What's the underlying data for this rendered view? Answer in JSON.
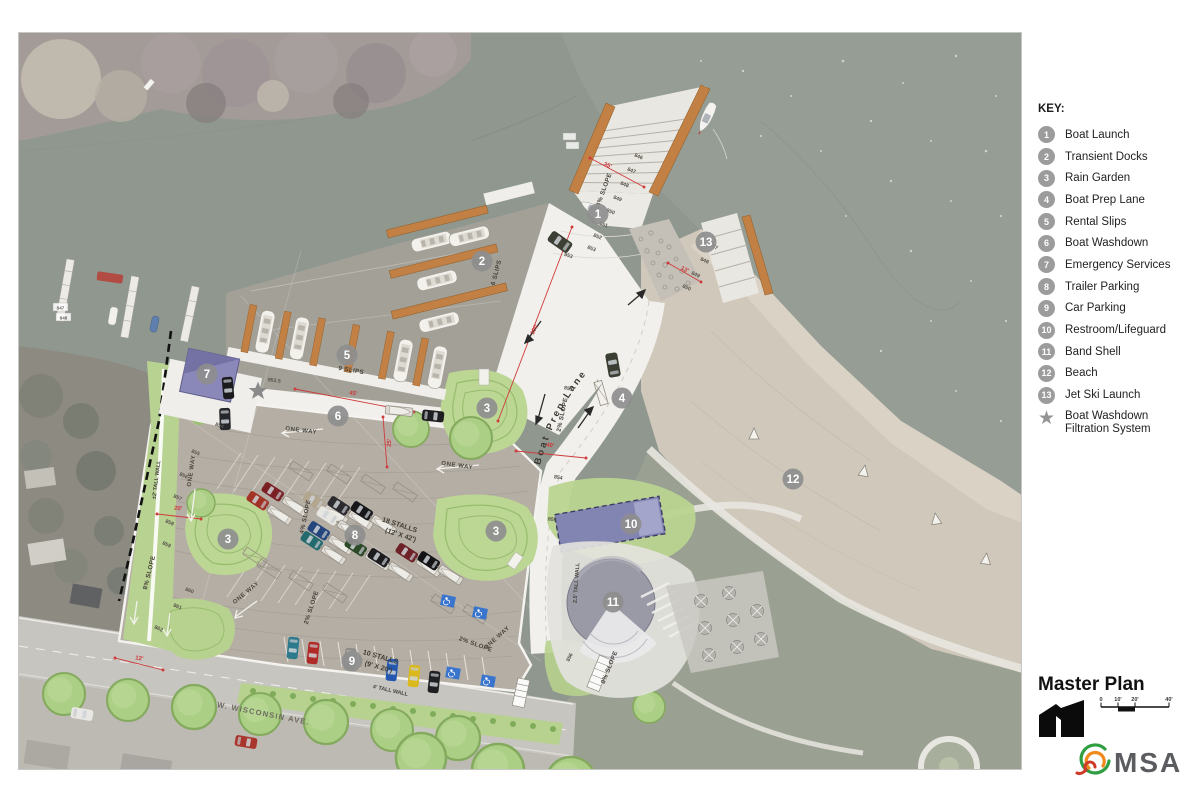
{
  "sheet": {
    "key": {
      "title": "KEY:",
      "items": [
        {
          "num": "1",
          "label": "Boat Launch"
        },
        {
          "num": "2",
          "label": "Transient Docks"
        },
        {
          "num": "3",
          "label": "Rain Garden"
        },
        {
          "num": "4",
          "label": "Boat Prep Lane"
        },
        {
          "num": "5",
          "label": "Rental Slips"
        },
        {
          "num": "6",
          "label": "Boat Washdown"
        },
        {
          "num": "7",
          "label": "Emergency Services"
        },
        {
          "num": "8",
          "label": "Trailer Parking"
        },
        {
          "num": "9",
          "label": "Car Parking"
        },
        {
          "num": "10",
          "label": "Restroom/Lifeguard"
        },
        {
          "num": "11",
          "label": "Band Shell"
        },
        {
          "num": "12",
          "label": "Beach"
        },
        {
          "num": "13",
          "label": "Jet Ski Launch"
        }
      ],
      "star": {
        "symbol": "★",
        "line1": "Boat Washdown",
        "line2": "Filtration System"
      }
    },
    "title": "Master Plan",
    "scale_bar": {
      "ticks": [
        "0",
        "10'",
        "20'",
        "40'"
      ]
    },
    "logo": {
      "text": "MSA"
    }
  },
  "map": {
    "markers": [
      "1",
      "2",
      "3",
      "4",
      "5",
      "6",
      "7",
      "8",
      "3",
      "3",
      "9",
      "10",
      "11",
      "12",
      "13"
    ],
    "slips": [
      "6 SLIPS",
      "9 SLIPS"
    ],
    "slopes": [
      "14% SLOPE",
      "2% SLOPE",
      "4% SLOPE",
      "2% SLOPE",
      "8% SLOPE",
      "2% SLOPE",
      "8% SLOPE"
    ],
    "one_way": "ONE WAY",
    "walls": [
      "±2' TALL WALL",
      "2.5' TALL WALL",
      "4' TALL WALL"
    ],
    "street_name": "W. WISCONSIN AVE.",
    "stalls": [
      "18 STALLS",
      "(12' X 42')",
      "10 STALLS",
      "(9' X 20')"
    ],
    "prep_lane": "Boat Prep Lane",
    "contours": [
      "846",
      "847",
      "848",
      "849",
      "850",
      "851",
      "852",
      "853",
      "853",
      "853.5",
      "853.5",
      "853",
      "854",
      "855",
      "854",
      "855",
      "856",
      "857",
      "858",
      "859",
      "860",
      "861",
      "862",
      "856",
      "847",
      "848",
      "849",
      "850",
      "847",
      "848"
    ],
    "dims": [
      "100'",
      "35'",
      "40'",
      "45'",
      "25'",
      "20'",
      "12'",
      "13'"
    ]
  },
  "colors": {
    "water": "#8F978F",
    "beach": "#CFC8BB",
    "parking": "#B5AEA5",
    "concrete": "#F1F0EC",
    "rain_garden_green": "#B9D48F",
    "dock_orange": "#C28045",
    "building_purple": "#8486B4",
    "marker_gray": "#8E8E8E",
    "dimension_red": "#CF3B3B"
  }
}
